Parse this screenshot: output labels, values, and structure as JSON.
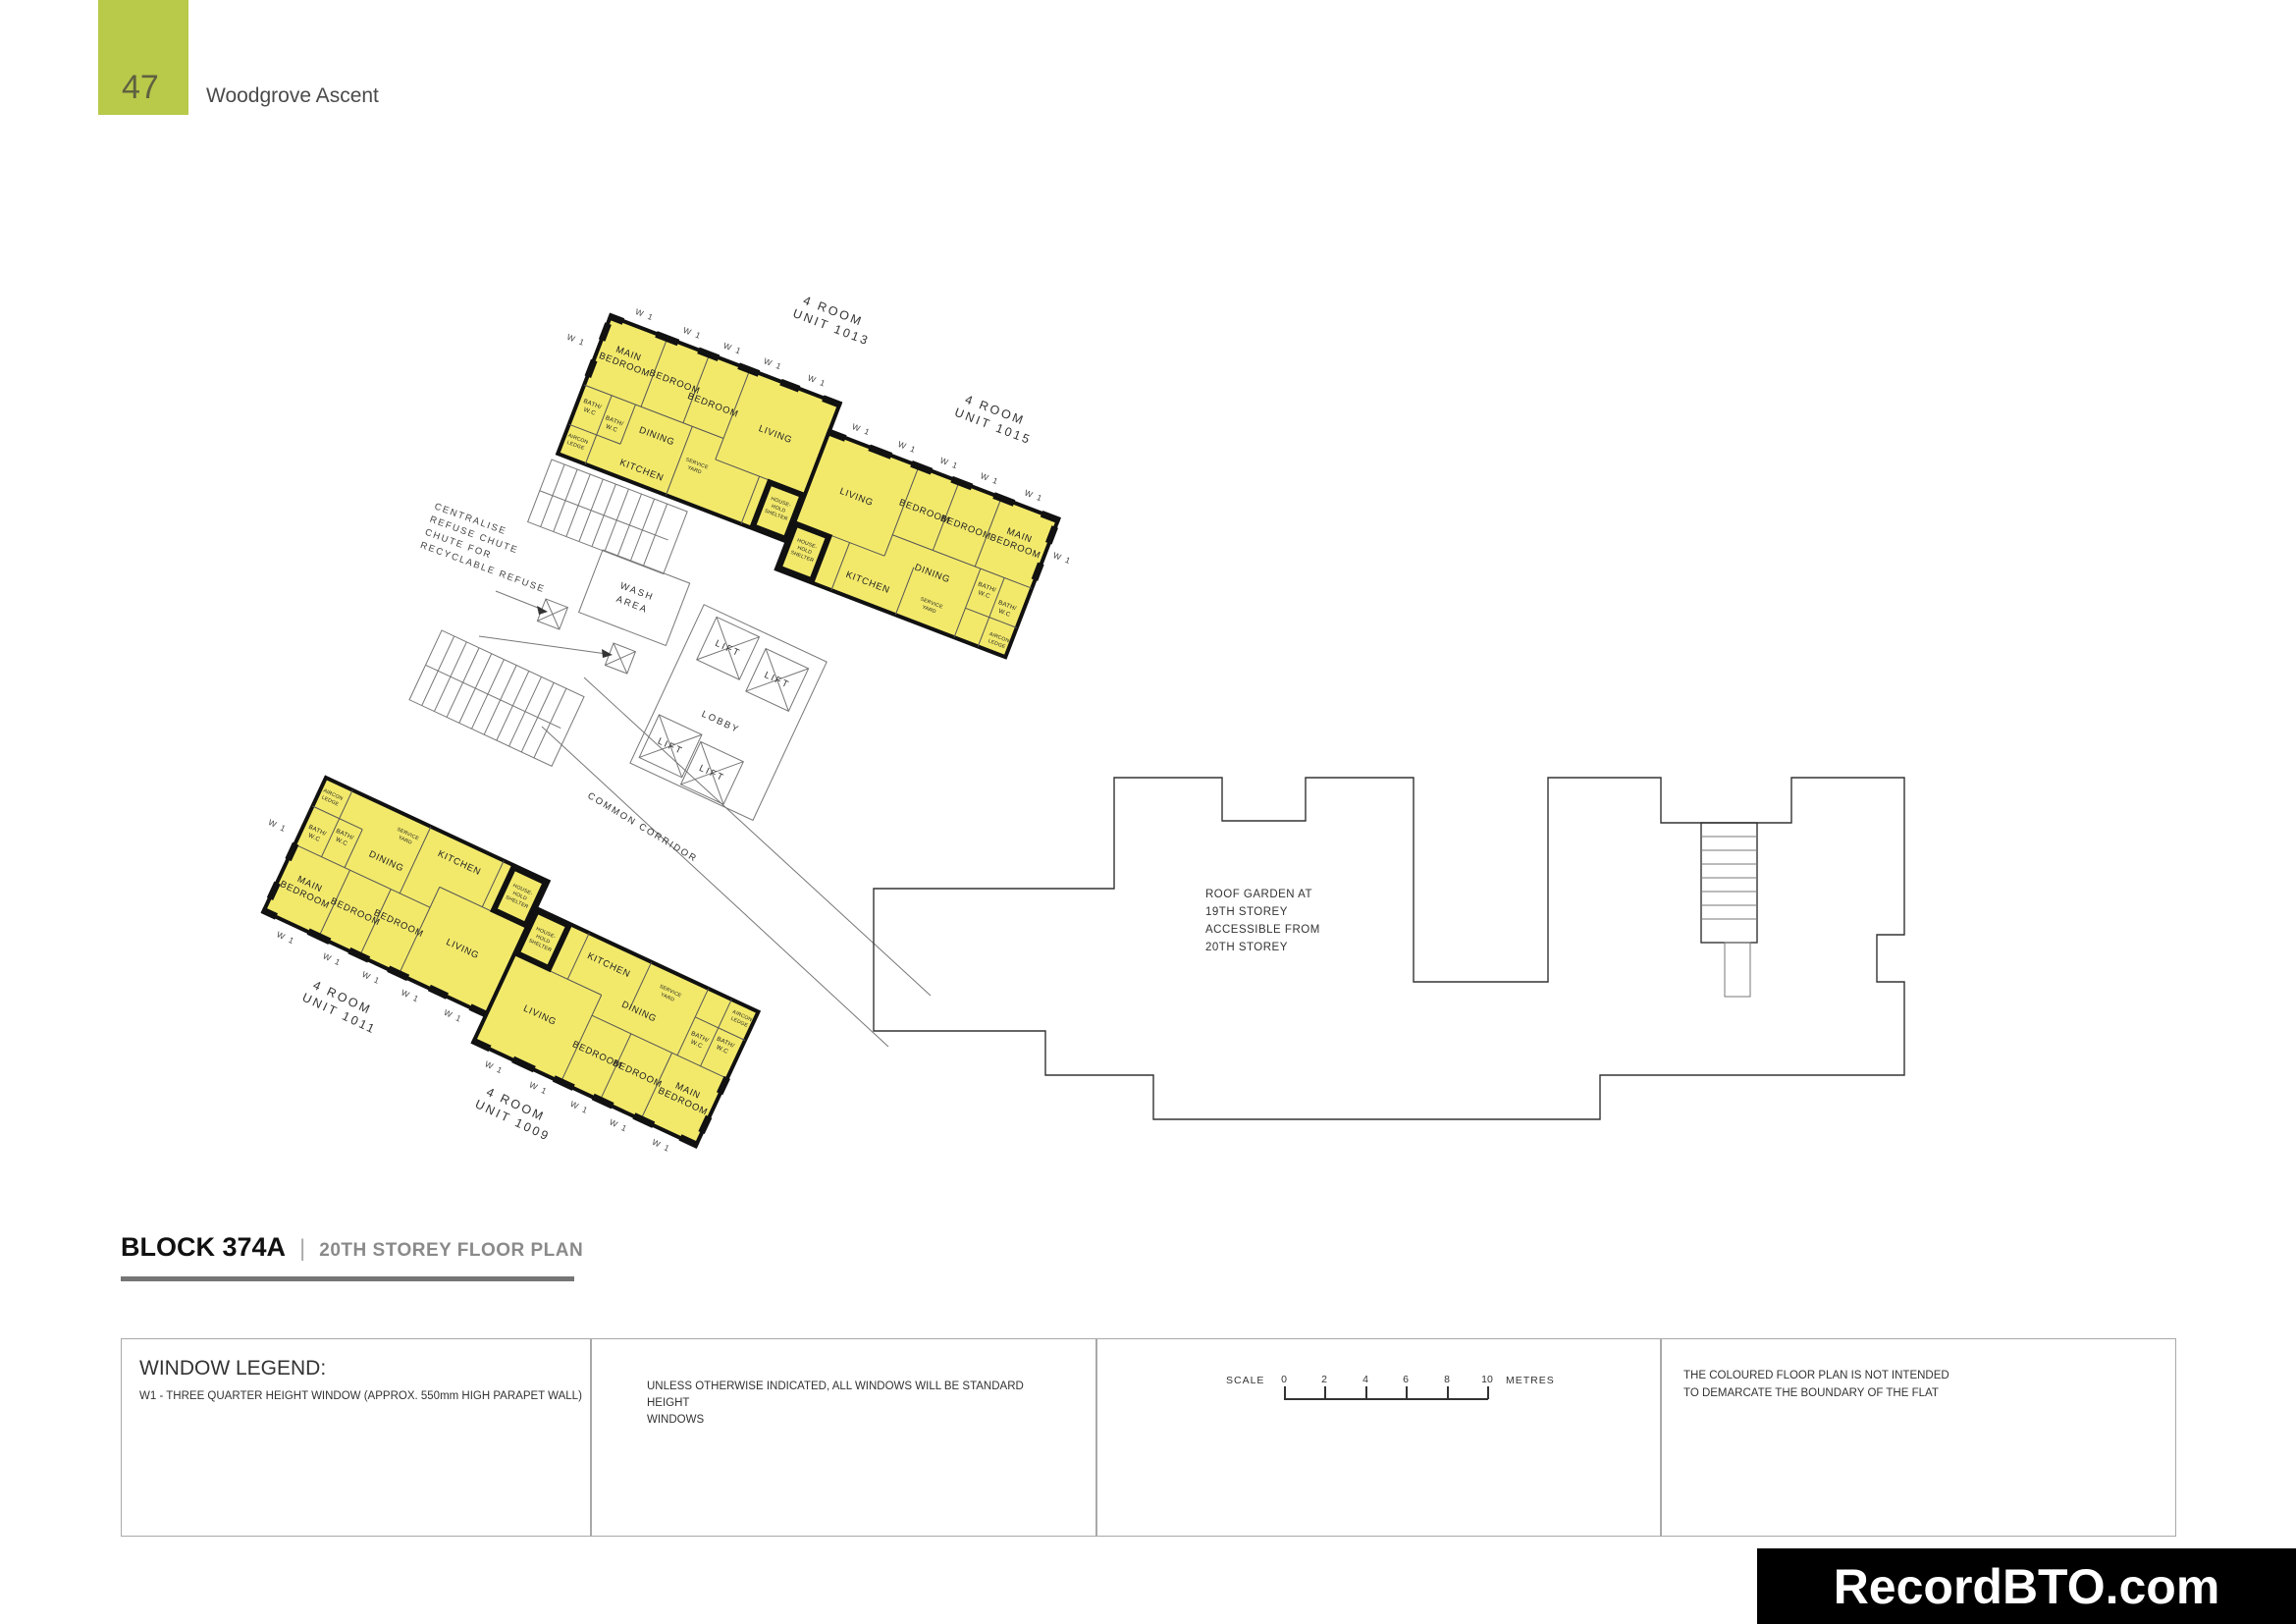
{
  "page": {
    "number": "47",
    "title": "Woodgrove Ascent"
  },
  "heading": {
    "block": "BLOCK 374A",
    "separator": "|",
    "plan_title": "20TH STOREY FLOOR PLAN"
  },
  "plan": {
    "window_label": "W 1",
    "rooms": {
      "main1": "MAIN",
      "main2": "BEDROOM",
      "bedroom": "BEDROOM",
      "living": "LIVING",
      "dining": "DINING",
      "kitchen": "KITCHEN",
      "bath1": "BATH/",
      "bath2": "W.C",
      "aircon1": "AIRCON",
      "aircon2": "LEDGE",
      "service1": "SERVICE",
      "service2": "YARD",
      "shelter1": "HOUSE-",
      "shelter2": "HOLD",
      "shelter3": "SHELTER"
    },
    "units": [
      {
        "line1": "4 ROOM",
        "line2": "UNIT 1013"
      },
      {
        "line1": "4 ROOM",
        "line2": "UNIT 1015"
      },
      {
        "line1": "4 ROOM",
        "line2": "UNIT 1011"
      },
      {
        "line1": "4 ROOM",
        "line2": "UNIT 1009"
      }
    ],
    "core": {
      "wash1": "WASH",
      "wash2": "AREA",
      "lift": "LIFT",
      "lobby": "LOBBY",
      "corridor": "COMMON CORRIDOR"
    },
    "notes": {
      "refuse": [
        "CENTRALISE",
        "REFUSE CHUTE",
        "CHUTE FOR",
        "RECYCLABLE REFUSE"
      ],
      "roof_garden": [
        "ROOF GARDEN AT",
        "19TH STOREY",
        "ACCESSIBLE FROM",
        "20TH STOREY"
      ]
    }
  },
  "legend": {
    "window_title": "WINDOW LEGEND:",
    "w1_note": "W1  -  THREE QUARTER HEIGHT WINDOW (APPROX. 550mm HIGH PARAPET WALL)",
    "windows_note1": "UNLESS OTHERWISE INDICATED,  ALL WINDOWS WILL BE STANDARD HEIGHT",
    "windows_note2": "WINDOWS",
    "scale_label": "SCALE",
    "scale_ticks": [
      "0",
      "2",
      "4",
      "6",
      "8",
      "10"
    ],
    "scale_unit": "METRES",
    "disclaimer1": "THE COLOURED FLOOR PLAN IS NOT INTENDED",
    "disclaimer2": "TO DEMARCATE THE BOUNDARY OF THE FLAT"
  },
  "watermark": "RecordBTO.com",
  "colors": {
    "accent_green": "#b9c94a",
    "unit_fill": "#f2e96b",
    "wall": "#111111"
  }
}
